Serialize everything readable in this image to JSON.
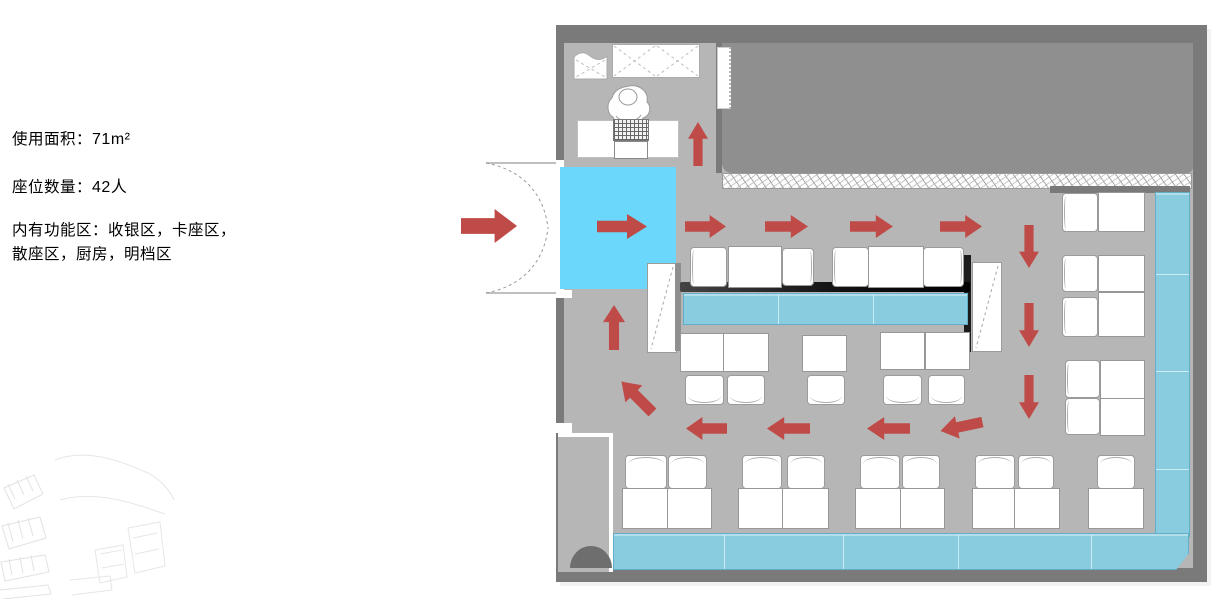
{
  "info_panel": {
    "area_label": "使用面积：",
    "area_value": "71m²",
    "seats_label": "座位数量：",
    "seats_value": "42人",
    "zones_line1": "内有功能区：收银区，卡座区，",
    "zones_line2": "散座区，厨房，明档区"
  },
  "plan": {
    "colors": {
      "wall": "#7a7a7a",
      "kitchen": "#8f8f8f",
      "floor": "#b6b6b6",
      "entrance": "#6bd7fa",
      "bench": "#8accdf",
      "arrow": "#bf4b48"
    }
  }
}
